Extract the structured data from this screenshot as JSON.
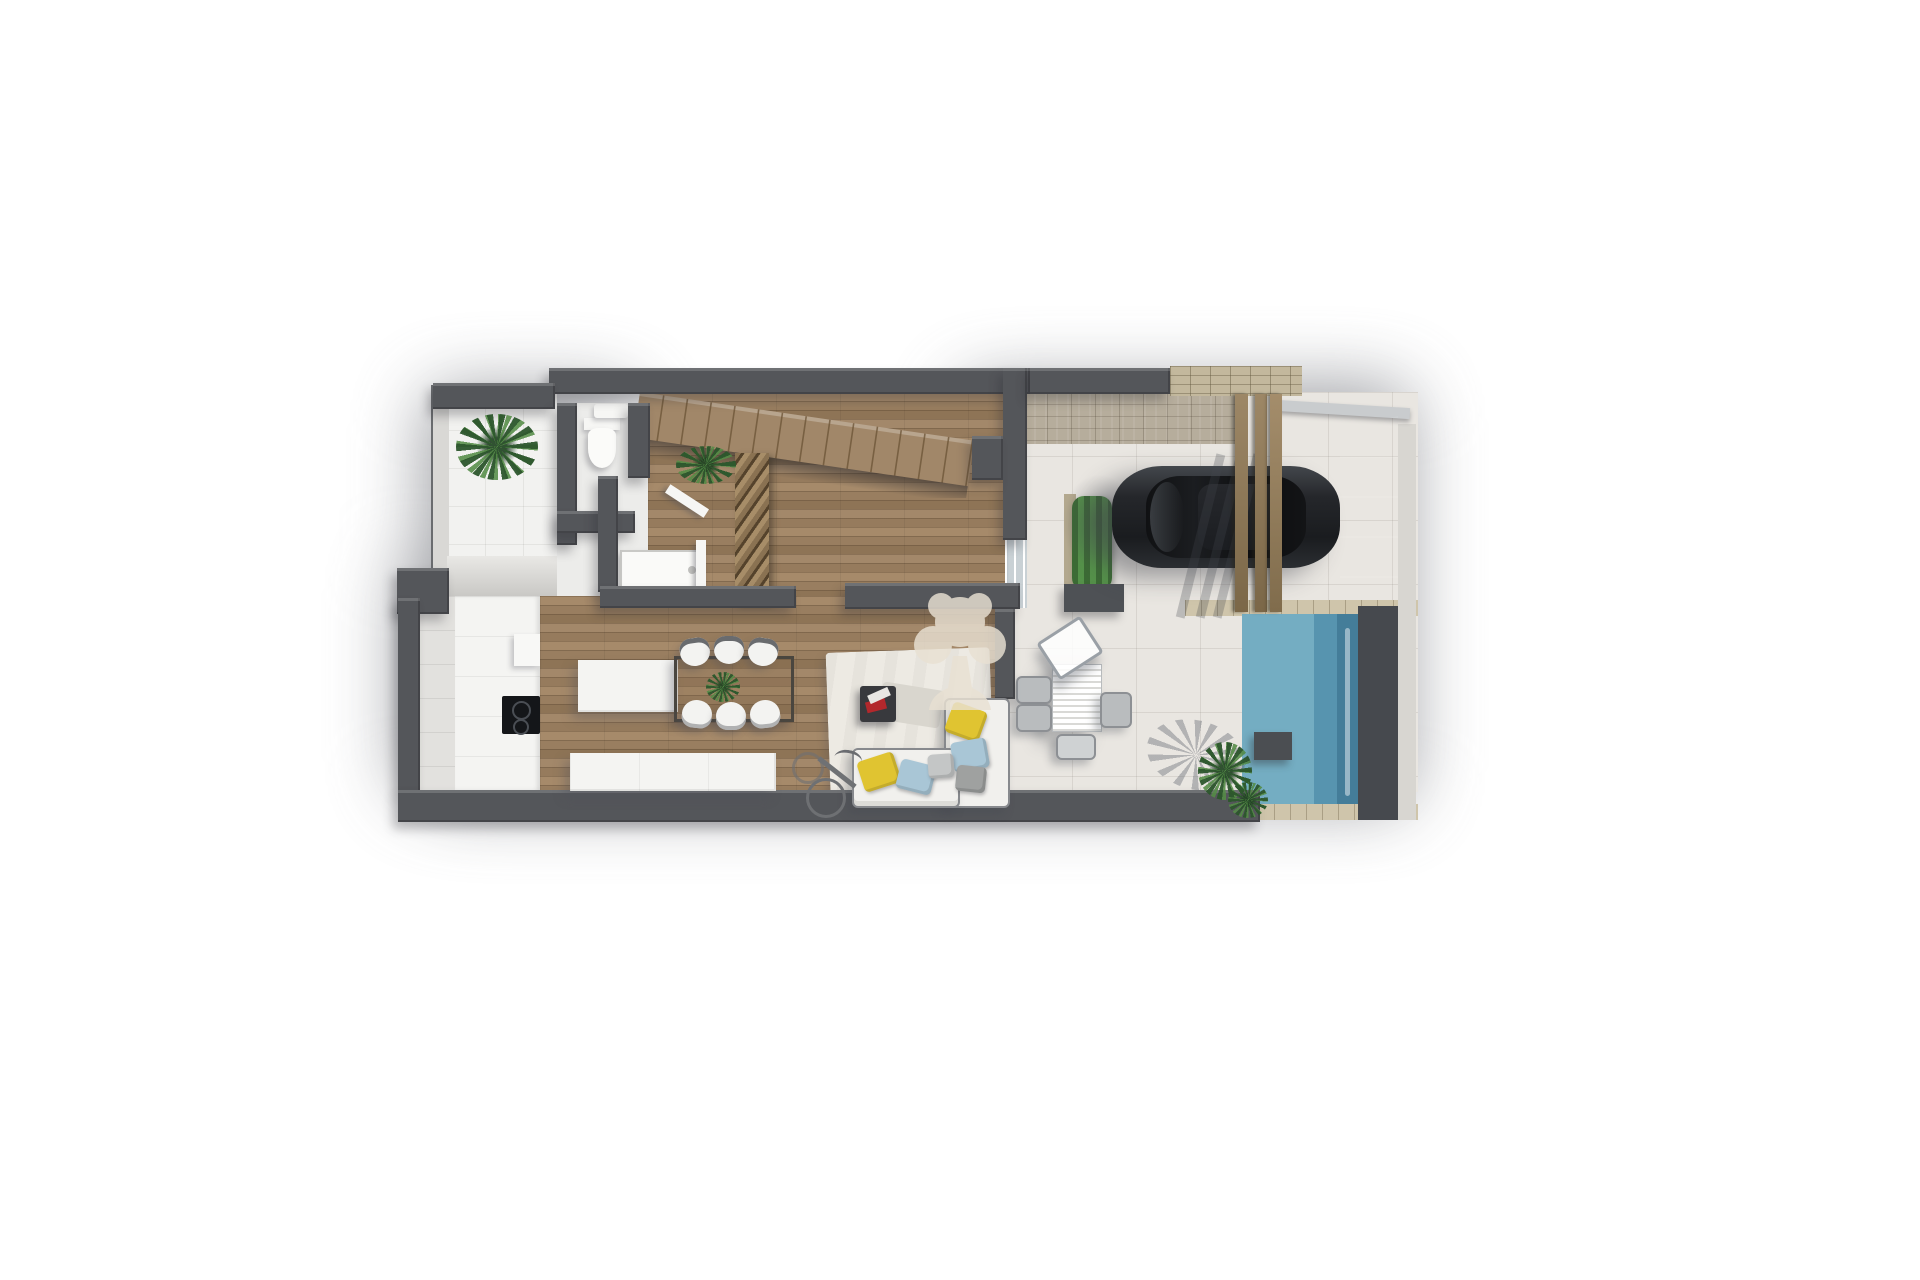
{
  "scene": {
    "type": "3d-top-down-floor-plan-render",
    "watermark_icon": "tree-logo"
  },
  "colors": {
    "bg": "#ffffff",
    "halo": "#82848a",
    "wall": "#54565a",
    "wall-light": "#d9d8d5",
    "wood": "#9c8164",
    "tile": "#f2f2f0",
    "bath": "#ececea",
    "terrace": "#e9e6e1",
    "stone": "#b6ad9c",
    "stone-wall": "#c3b89d",
    "coping": "#cfc5ab",
    "pool-light": "#74adc2",
    "pool-mid": "#5794af",
    "pool-dark": "#447d99",
    "pool-wall": "#46494e",
    "car-body": "#1d1f22",
    "beam": "#8d7a5e",
    "green": "#3f7a3a",
    "green-dark": "#2c5630",
    "green-light": "#548c46",
    "sofa": "#f1f0ed",
    "cushion-yellow": "#e0c431",
    "cushion-blue": "#a9c6d6",
    "cushion-gray": "#9fa1a0",
    "rug": "#edeae3",
    "watermark": "#e9e1d3"
  },
  "rooms": [
    {
      "name": "entry-patio"
    },
    {
      "name": "guest-wc"
    },
    {
      "name": "bathroom"
    },
    {
      "name": "hallway-staircase"
    },
    {
      "name": "kitchen"
    },
    {
      "name": "living-dining-room"
    },
    {
      "name": "carport-driveway"
    },
    {
      "name": "terrace"
    },
    {
      "name": "swimming-pool"
    },
    {
      "name": "garden"
    }
  ],
  "objects": [
    {
      "name": "potted-plant"
    },
    {
      "name": "toilet"
    },
    {
      "name": "washbasin"
    },
    {
      "name": "shower-tray"
    },
    {
      "name": "staircase"
    },
    {
      "name": "slatted-screen"
    },
    {
      "name": "kitchen-counter"
    },
    {
      "name": "cooktop"
    },
    {
      "name": "refrigerator"
    },
    {
      "name": "kitchen-island"
    },
    {
      "name": "dining-table"
    },
    {
      "name": "dining-chairs"
    },
    {
      "name": "sideboard"
    },
    {
      "name": "area-rug"
    },
    {
      "name": "coffee-table"
    },
    {
      "name": "corner-sofa"
    },
    {
      "name": "cushions"
    },
    {
      "name": "bicycle"
    },
    {
      "name": "car"
    },
    {
      "name": "pergola-beams"
    },
    {
      "name": "planter"
    },
    {
      "name": "outdoor-dining-set"
    },
    {
      "name": "palm-tree-shadow"
    },
    {
      "name": "garden-plants"
    },
    {
      "name": "pool-water"
    }
  ]
}
